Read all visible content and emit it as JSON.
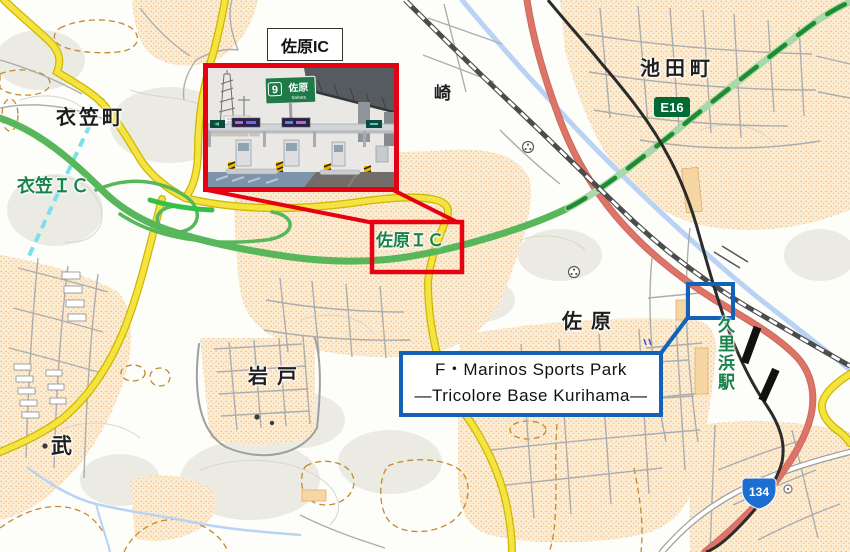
{
  "map": {
    "labels": {
      "ikedacho": "池田町",
      "saki": "崎",
      "kinugasacho": "衣笠町",
      "kinugasa_ic": "衣笠ＩＣ",
      "sahara_ic": "佐原ＩＣ",
      "sahara": "佐原",
      "iwato": "岩戸",
      "take": "武",
      "kurihama_station": "久里浜駅"
    },
    "badges": {
      "e16": "E16",
      "route_134": "134"
    },
    "colors": {
      "annotation_red": "#e60012",
      "annotation_blue": "#1262b8",
      "expressway_green": "#58b75b",
      "expressway_light_green": "#a9d8a9",
      "road_yellow": "#f4e340",
      "road_red": "#de7468",
      "river_blue": "#b9d3f4",
      "label_green": "#17824a",
      "e16_badge_green": "#006934",
      "route_shield_blue": "#1c6fd1"
    }
  },
  "callouts": {
    "sahara_ic_photo_label": "佐原IC",
    "sports_park_line1": "F・Marinos Sports Park",
    "sports_park_line2": "―Tricolore Base Kurihama―"
  },
  "photo": {
    "sign_exit_number": "9",
    "sign_name_jp": "佐原",
    "sign_name_en": "Sahara"
  }
}
